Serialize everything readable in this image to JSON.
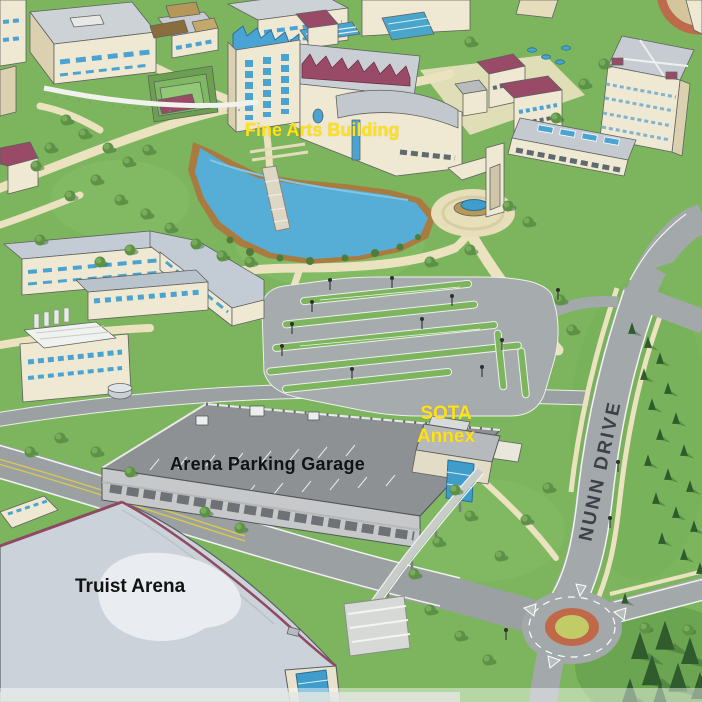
{
  "map": {
    "description": "Illustrated isometric university campus map, south-east quadrant with arena, parking garage and Nunn Drive",
    "labels": {
      "fine_arts_building": "Fine Arts Building",
      "sota_annex_line1": "SOTA",
      "sota_annex_line2": "Annex",
      "arena_parking_garage": "Arena Parking Garage",
      "truist_arena": "Truist Arena",
      "nunn_drive": "NUNN DRIVE"
    },
    "label_colors": {
      "highlight_yellow": "#ffe117",
      "building_black": "#121212",
      "road_gray": "#3d4147"
    },
    "palette": {
      "grass": "#7cb55e",
      "grass_light": "#8cc06c",
      "path_cream": "#ebe2c0",
      "road_gray": "#9ba0a3",
      "road_light": "#a6abae",
      "water_blue": "#56aed7",
      "shore_brown": "#aa7b40",
      "wall_cream": "#efe8d2",
      "wall_tan": "#dbd1b0",
      "roof_gray": "#c9cfd4",
      "roof_maroon": "#984a66",
      "glass_blue": "#4aa4d3",
      "arena_roof": "#cbd2d9",
      "garage_deck": "#8d9194",
      "roundabout_ring": "#c0684a",
      "roundabout_center": "#c2cc67",
      "tree_dark": "#2f5b2d",
      "tree_mid": "#5d9146",
      "lane_yellow": "#d9c94f"
    }
  }
}
